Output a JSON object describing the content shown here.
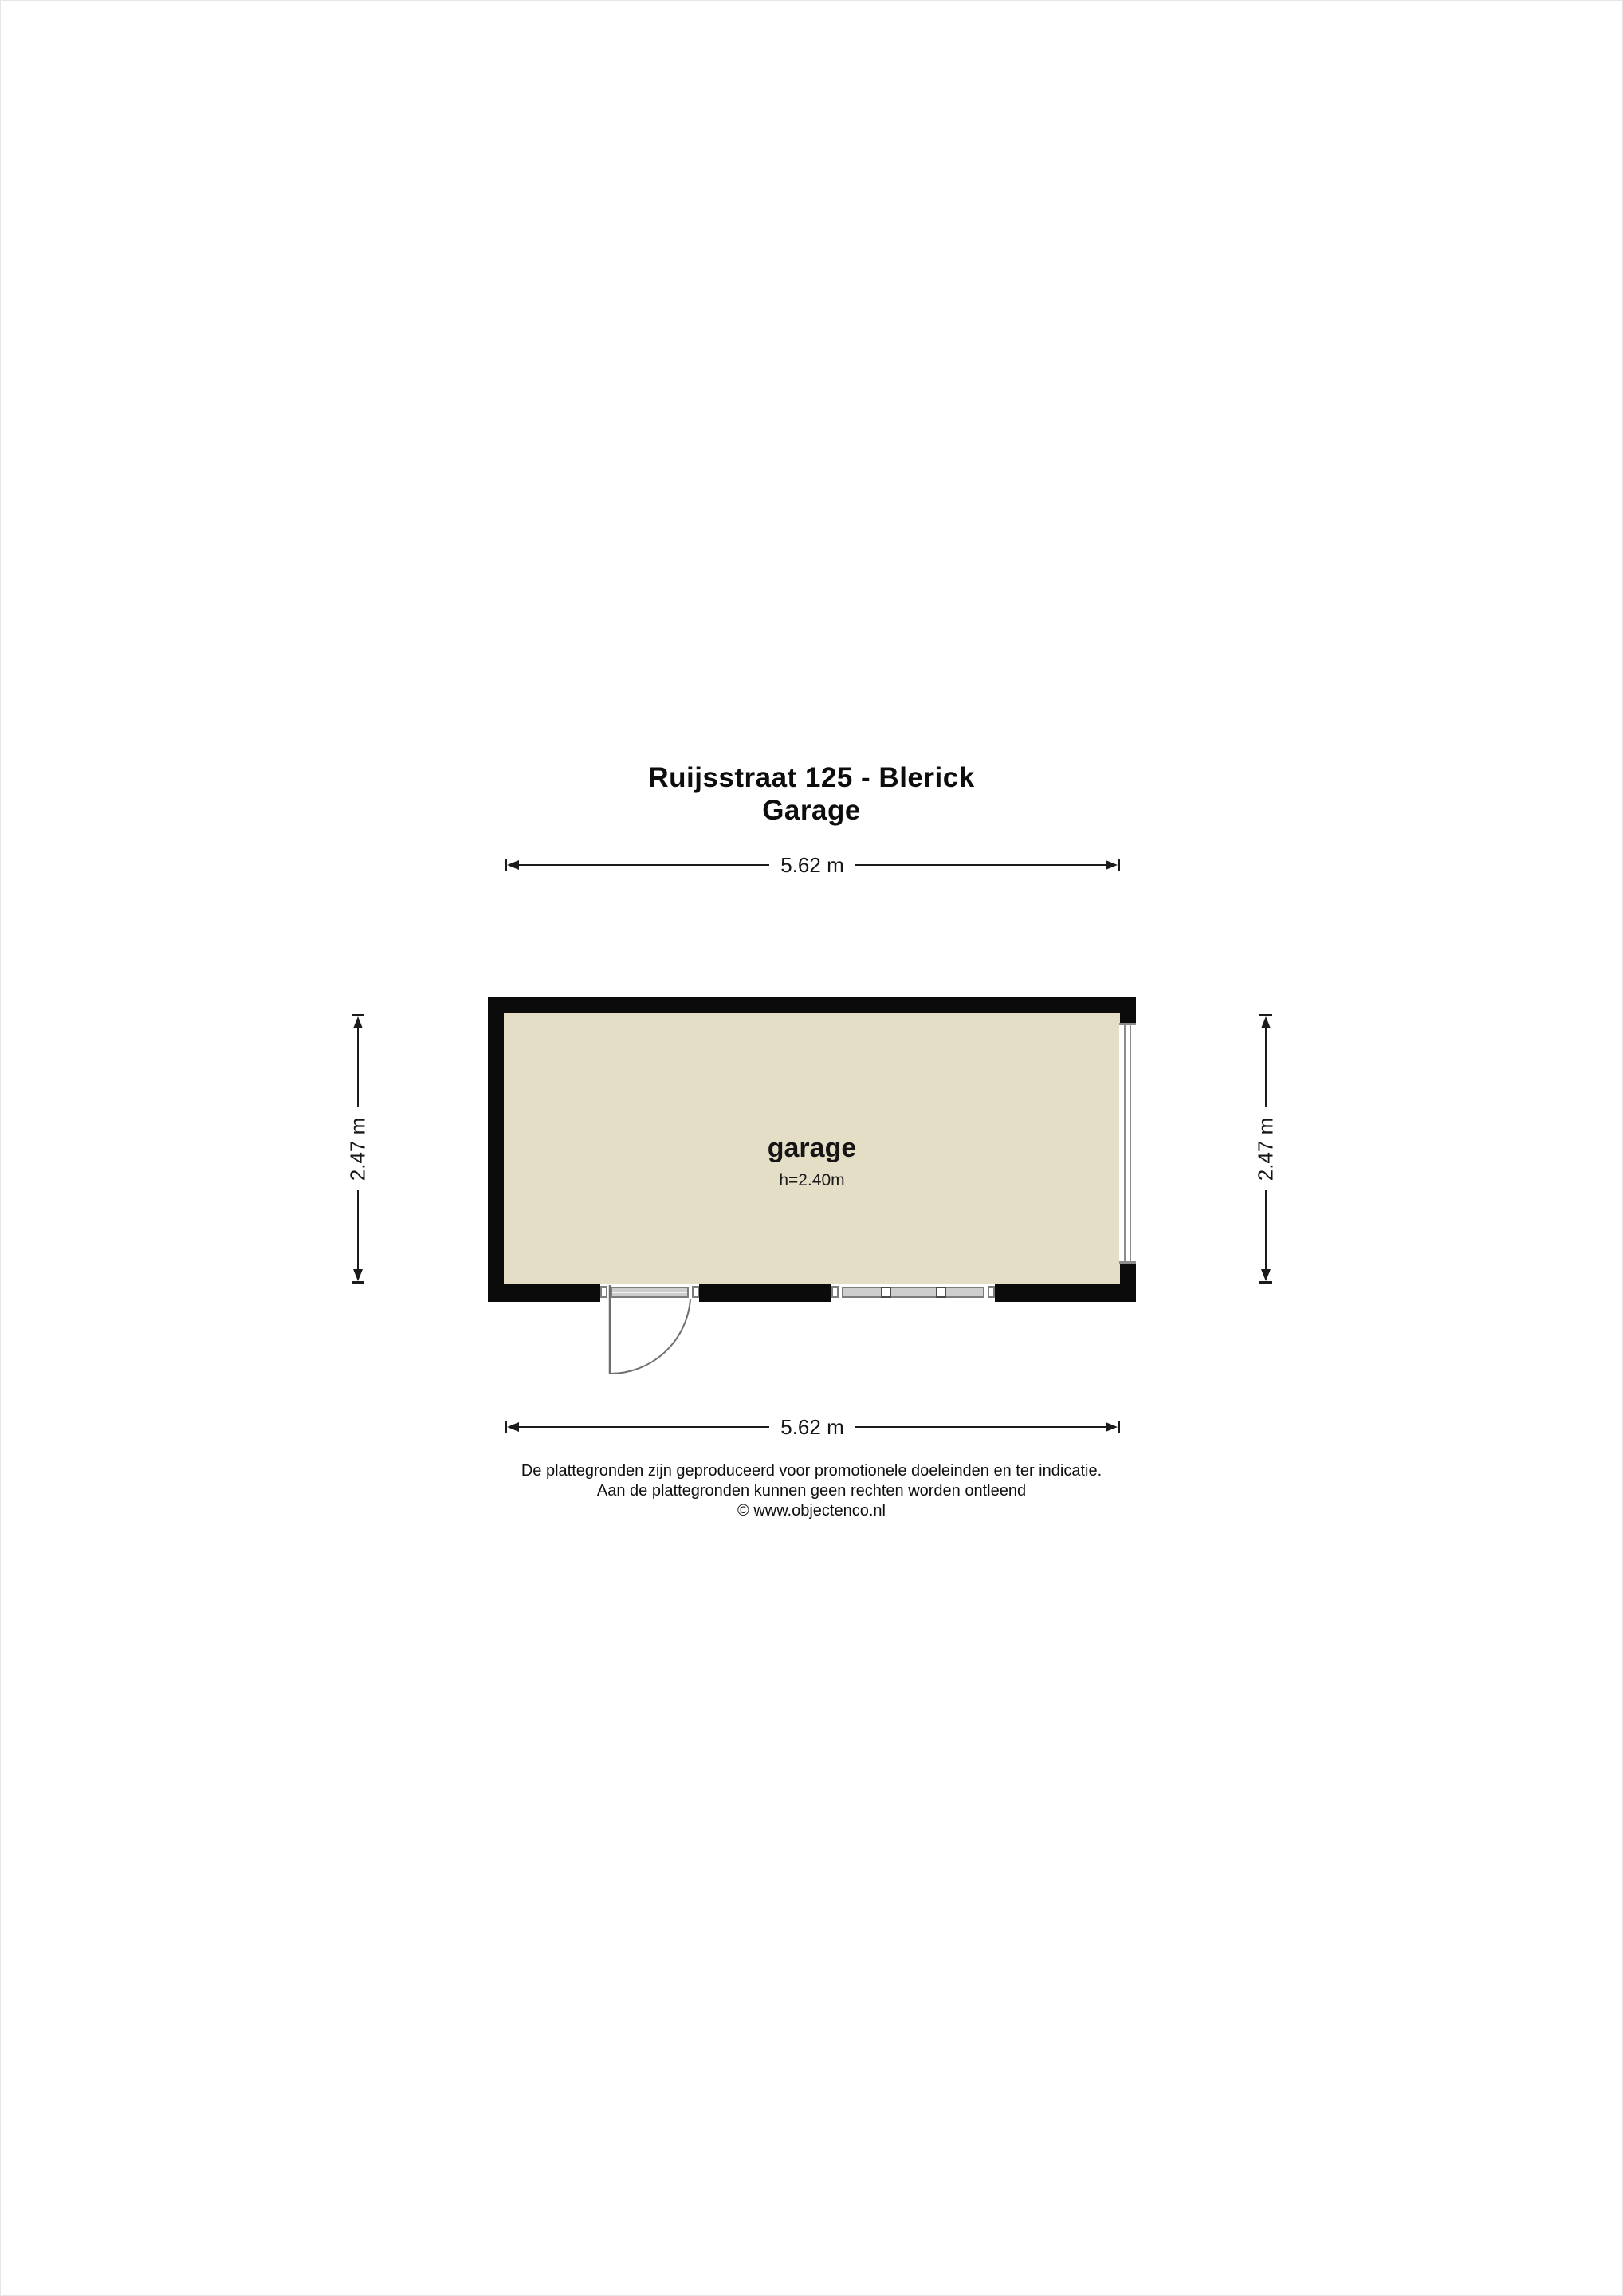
{
  "title": {
    "line1": "Ruijsstraat 125 - Blerick",
    "line2": "Garage"
  },
  "floorplan": {
    "room": {
      "name": "garage",
      "height_label": "h=2.40m"
    },
    "dimensions": {
      "top": "5.62 m",
      "bottom": "5.62 m",
      "left": "2.47 m",
      "right": "2.47 m"
    },
    "colors": {
      "wall": "#0b0b0b",
      "floor": "#e5dec6",
      "frame_fill": "#cdcdcd",
      "frame_border": "#7c7c7c",
      "frame_line": "#8c8c8c",
      "door_line": "#6e6e6e",
      "dim_line": "#1b1b1b"
    }
  },
  "footer": {
    "line1": "De plattegronden zijn geproduceerd voor promotionele doeleinden en ter indicatie.",
    "line2": "Aan de plattegronden kunnen geen rechten worden ontleend",
    "line3": "© www.objectenco.nl"
  }
}
